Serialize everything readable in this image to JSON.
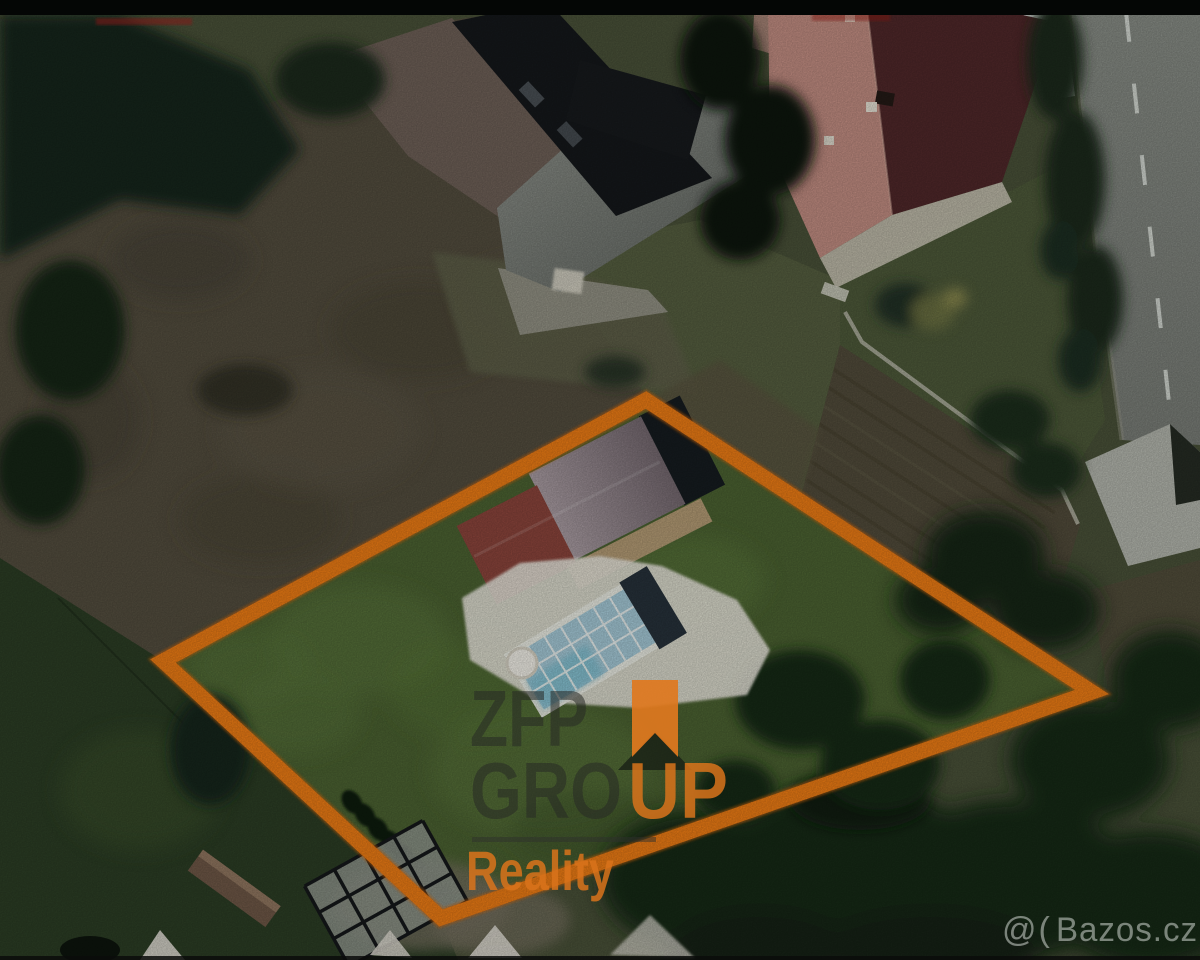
{
  "watermarks": {
    "agency": {
      "line1": "ZFP",
      "line2_gray": "GRO",
      "line2_orange": "UP",
      "line3": "Reality"
    },
    "listing_site": {
      "mark": "@(",
      "name": "Bazos.cz"
    }
  },
  "colors": {
    "boundary_orange": "#EF7D15",
    "watermark_orange": "rgba(217,115,27,0.85)",
    "watermark_gray": "rgba(38,40,36,0.55)",
    "bazos_watermark_gray": "rgba(210,215,210,0.55)",
    "letterbox_black": "#040605"
  }
}
